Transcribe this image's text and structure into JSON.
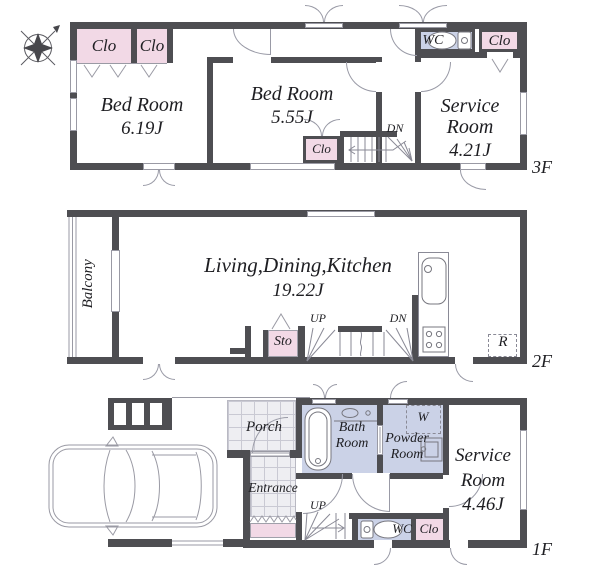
{
  "title": "3-story house floor plan",
  "colors": {
    "wall": "#4e4e52",
    "closet_pink": "#f2d9e6",
    "wet_area_blue": "#cbd2e7",
    "tile_gray": "#eeeef2",
    "line_gray": "#999aa6"
  },
  "floor3": {
    "label": "3F",
    "bedroom1": {
      "name": "Bed Room",
      "area": "6.19J"
    },
    "bedroom2": {
      "name": "Bed Room",
      "area": "5.55J"
    },
    "service_room": {
      "name": "Service Room",
      "area": "4.21J"
    },
    "wc": "WC",
    "clo1": "Clo",
    "clo2": "Clo",
    "clo3": "Clo",
    "clo4": "Clo",
    "dn": "DN"
  },
  "floor2": {
    "label": "2F",
    "ldk": {
      "name": "Living,Dining,Kitchen",
      "area": "19.22J"
    },
    "balcony": "Balcony",
    "sto": "Sto",
    "up": "UP",
    "dn": "DN",
    "refrigerator": "R"
  },
  "floor1": {
    "label": "1F",
    "porch": "Porch",
    "entrance": "Entrance",
    "bath": {
      "name": "Bath Room"
    },
    "powder": {
      "name": "Powder Room",
      "washer": "W"
    },
    "service_room": {
      "name": "Service Room",
      "area": "4.46J"
    },
    "wc": "WC",
    "clo": "Clo",
    "up": "UP"
  }
}
